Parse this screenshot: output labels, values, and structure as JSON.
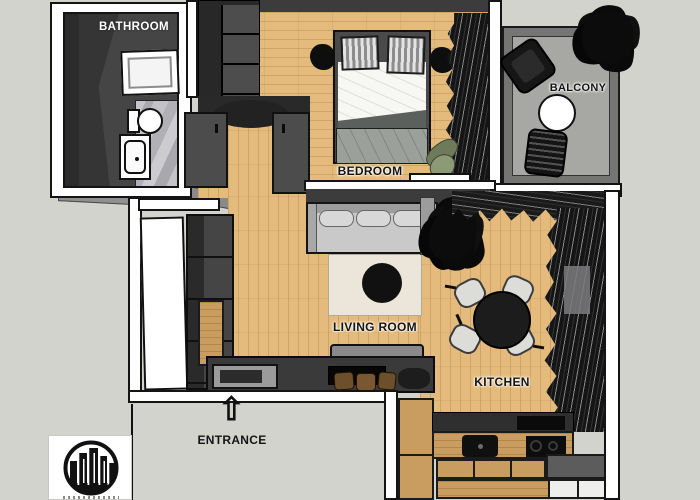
{
  "title": "Apartment floor plan",
  "rooms": {
    "bathroom": {
      "label": "BATHROOM"
    },
    "bedroom": {
      "label": "BEDROOM"
    },
    "balcony": {
      "label": "BALCONY"
    },
    "living_room": {
      "label": "LIVING ROOM"
    },
    "kitchen": {
      "label": "KITCHEN"
    }
  },
  "entrance": {
    "label": "ENTRANCE",
    "arrow_glyph": "⇧"
  },
  "icons": {
    "entrance_arrow": "up-white-arrow",
    "logo": "city-skyline-in-circle"
  },
  "colors": {
    "background": "#d3d3cd",
    "wall_white": "#ffffff",
    "outline": "#141414",
    "interior_dark_wall": "#3c3c3c",
    "wood_floor": "#e5bb7d",
    "balcony_floor": "#a7a7a3",
    "marble_tile": "#bfbfc4",
    "rug": "#ebe6d9",
    "sofa": "#c9c9c9",
    "accent_green_chair": "#8d9a76"
  }
}
